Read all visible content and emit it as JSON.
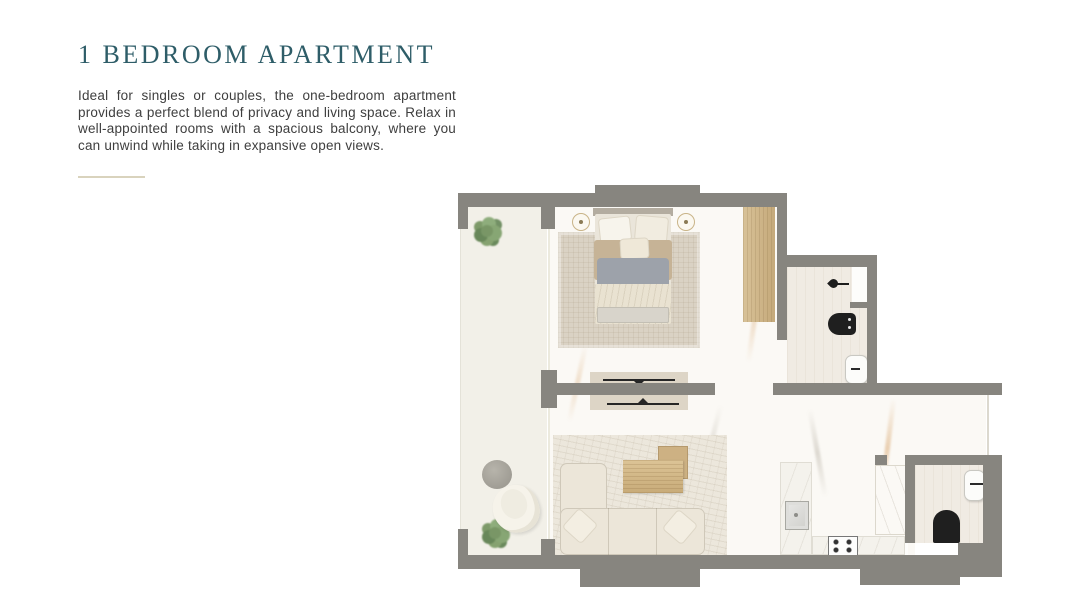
{
  "header": {
    "title": "1 BEDROOM APARTMENT",
    "description": "Ideal for singles or couples, the one-bedroom apartment provides a perfect blend of privacy and living space. Relax in well-appointed rooms with a spacious balcony, where you can unwind while taking in expansive open views."
  },
  "palette": {
    "teal": "#2e5d68",
    "text": "#3e3e3e",
    "divider": "#d9d3bd",
    "wall": "#87857f",
    "balconyFloor": "#f2f0e8",
    "marbleFloor": "#fbf9f5",
    "bathFloor": "#f0ebe3",
    "wood": "#d0b78c",
    "rugBedroom": "#dad2c4",
    "rugLiving": "#ece7dc",
    "sofa": "#ece6d9",
    "vein": "#d8a66e",
    "fixtureBlack": "#1f1f1f"
  },
  "floorplan": {
    "rooms": [
      "balcony",
      "bedroom",
      "bathroom",
      "living-room",
      "kitchen",
      "guest-bathroom"
    ],
    "fixtures": [
      "double-bed",
      "bedside-lamps",
      "wardrobe",
      "tv-console",
      "sofa",
      "coffee-tables",
      "kitchen-sink",
      "gas-stove",
      "toilet",
      "wash-basin",
      "shower",
      "lounge-chair",
      "round-table",
      "plants"
    ]
  }
}
